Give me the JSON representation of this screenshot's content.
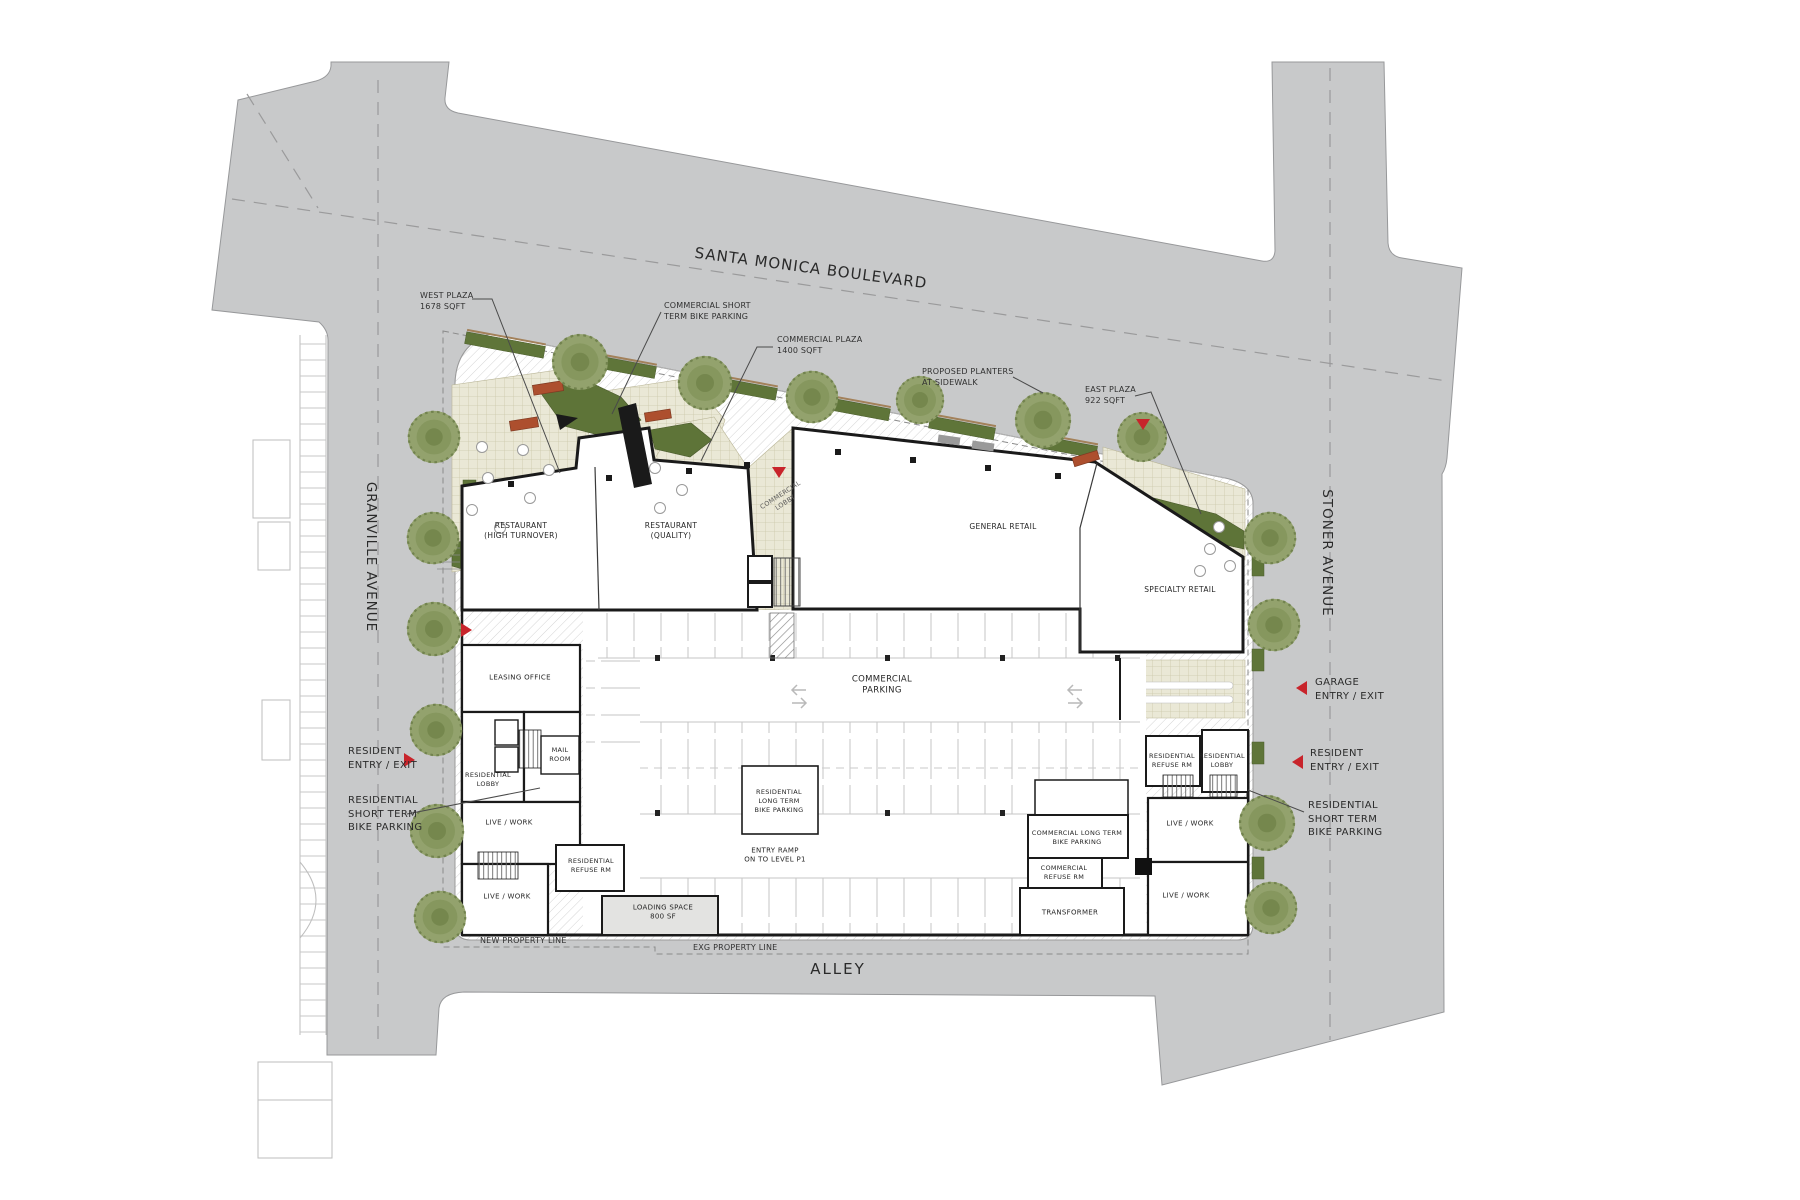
{
  "drawing": {
    "streets": {
      "top": "SANTA MONICA BOULEVARD",
      "left": "GRANVILLE AVENUE",
      "right": "STONER AVENUE",
      "bottom": "ALLEY"
    },
    "property_lines": {
      "new_line": "NEW PROPERTY LINE",
      "existing_line": "EXG PROPERTY LINE"
    },
    "plaza_callouts": {
      "west": "WEST PLAZA\n1678 SQFT",
      "commercial": "COMMERCIAL PLAZA\n1400 SQFT",
      "east": "EAST PLAZA\n922 SQFT"
    },
    "sidewalk_callouts": {
      "commercial_bike": "COMMERCIAL SHORT\nTERM BIKE PARKING",
      "planters": "PROPOSED PLANTERS\nAT SIDEWALK",
      "residential_bike_left": "RESIDENTIAL\nSHORT TERM\nBIKE PARKING",
      "residential_bike_right": "RESIDENTIAL\nSHORT TERM\nBIKE PARKING"
    },
    "entries": {
      "resident_left": "RESIDENT\nENTRY / EXIT",
      "garage_right": "GARAGE\nENTRY / EXIT",
      "resident_right": "RESIDENT\nENTRY / EXIT"
    },
    "rooms": {
      "restaurant_high_turnover": "RESTAURANT\n(HIGH TURNOVER)",
      "restaurant_quality": "RESTAURANT\n(QUALITY)",
      "general_retail": "GENERAL RETAIL",
      "specialty_retail": "SPECIALTY RETAIL",
      "commercial_parking": "COMMERCIAL\nPARKING",
      "commercial_lobby": "COMMERCIAL\nLOBBY",
      "leasing_office": "LEASING OFFICE",
      "mail_room": "MAIL\nROOM",
      "residential_lobby_left": "RESIDENTIAL\nLOBBY",
      "live_work_left_upper": "LIVE / WORK",
      "live_work_left_lower": "LIVE / WORK",
      "residential_refuse_left": "RESIDENTIAL\nREFUSE RM",
      "loading_space": "LOADING SPACE\n800 SF",
      "residential_bike_room": "RESIDENTIAL\nLONG TERM\nBIKE PARKING",
      "entry_ramp": "ENTRY RAMP\nON TO LEVEL P1",
      "commercial_bike_room": "COMMERCIAL LONG TERM\nBIKE PARKING",
      "commercial_refuse": "COMMERCIAL\nREFUSE RM",
      "transformer": "TRANSFORMER",
      "residential_refuse_right": "RESIDENTIAL\nREFUSE RM",
      "residential_lobby_right": "RESIDENTIAL\nLOBBY",
      "live_work_right_upper": "LIVE / WORK",
      "live_work_right_lower": "LIVE / WORK"
    },
    "colors": {
      "street_gray": "#c8c9ca",
      "plaza_paving": "#eae8d6",
      "planting_green": "#5e7438",
      "tree_green": "#93a26d",
      "entry_red": "#c8242b",
      "wall_black": "#1a1a1a"
    }
  }
}
